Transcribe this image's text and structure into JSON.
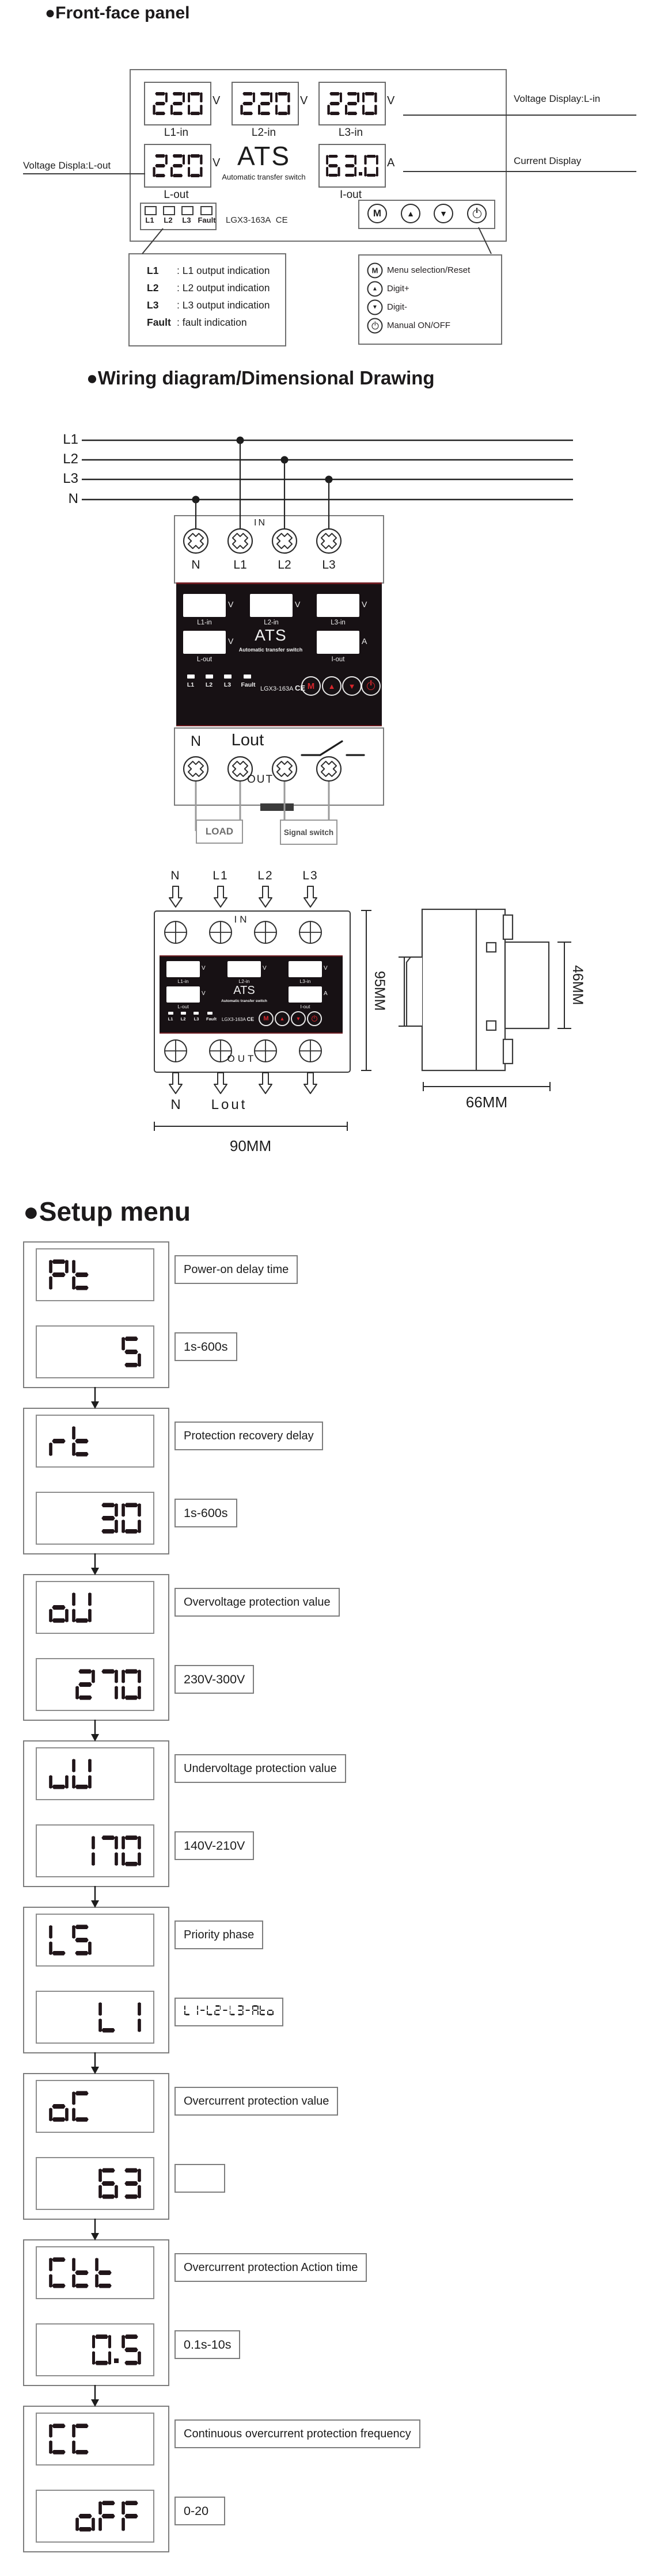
{
  "front_panel": {
    "heading": "●Front-face panel",
    "displays": {
      "l1_in": {
        "value": "220",
        "unit": "V",
        "caption": "L1-in"
      },
      "l2_in": {
        "value": "220",
        "unit": "V",
        "caption": "L2-in"
      },
      "l3_in": {
        "value": "220",
        "unit": "V",
        "caption": "L3-in"
      },
      "l_out": {
        "value": "220",
        "unit": "V",
        "caption": "L-out"
      },
      "i_out": {
        "value": "63.0",
        "unit": "A",
        "caption": "I-out"
      }
    },
    "ats_title": "ATS",
    "ats_subtitle": "Automatic transfer switch",
    "model": "LGX3-163A",
    "ce_mark": "CE",
    "indicators": [
      "L1",
      "L2",
      "L3",
      "Fault"
    ],
    "buttons": {
      "menu": "M",
      "up": "▲",
      "down": "▼"
    },
    "annotations": {
      "voltage_in": "Voltage Display:L-in",
      "current": "Current Display",
      "voltage_out": "Voltage Displa:L-out"
    },
    "legend_indicators": [
      {
        "key": "L1",
        "desc": ": L1 output indication"
      },
      {
        "key": "L2",
        "desc": ": L2 output indication"
      },
      {
        "key": "L3",
        "desc": ": L3 output indication"
      },
      {
        "key": "Fault",
        "desc": ": fault indication"
      }
    ],
    "legend_buttons": [
      {
        "glyph": "M",
        "desc": "Menu selection/Reset"
      },
      {
        "glyph": "▲",
        "desc": "Digit+"
      },
      {
        "glyph": "▼",
        "desc": "Digit-"
      },
      {
        "glyph": "power",
        "desc": "Manual ON/OFF"
      }
    ]
  },
  "device_face": {
    "captions": [
      "L1-in",
      "L2-in",
      "L3-in",
      "L-out",
      "I-out"
    ],
    "unit_v": "V",
    "unit_a": "A",
    "ats_title": "ATS",
    "ats_subtitle": "Automatic transfer switch",
    "model": "LGX3-163A",
    "ce_mark": "CE",
    "indicators": [
      "L1",
      "L2",
      "L3",
      "Fault"
    ],
    "buttons": {
      "menu": "M",
      "up": "▲",
      "down": "▼"
    }
  },
  "wiring": {
    "heading": "●Wiring diagram/Dimensional Drawing",
    "bus_labels": [
      "L1",
      "L2",
      "L3",
      "N"
    ],
    "in_terminal_labels": [
      "N",
      "L1",
      "L2",
      "L3"
    ],
    "in_label": "IN",
    "out_label": "OUT",
    "out_terminal_labels": {
      "n": "N",
      "lout": "Lout"
    },
    "load_label": "LOAD",
    "signal_switch_label": "Signal switch"
  },
  "dimensional": {
    "top_labels": [
      "N",
      "L1",
      "L2",
      "L3"
    ],
    "in_label": "IN",
    "out_label": "OUT",
    "bottom_labels": {
      "n": "N",
      "lout": "Lout"
    },
    "width_label": "90MM",
    "height_label": "95MM",
    "rail_label": "35MM",
    "front_depth_label": "46MM",
    "depth_label": "66MM"
  },
  "setup_menu": {
    "heading": "●Setup menu",
    "items": [
      {
        "code": "Pt",
        "value": "5",
        "name": "Power-on delay time",
        "range": "1s-600s"
      },
      {
        "code": "rt",
        "value": "30",
        "name": "Protection recovery delay",
        "range": "1s-600s"
      },
      {
        "code": "oU",
        "value": "270",
        "name": "Overvoltage protection value",
        "range": "230V-300V"
      },
      {
        "code": "uU",
        "value": "170",
        "name": "Undervoltage protection value",
        "range": "140V-210V"
      },
      {
        "code": "LS",
        "value": "L1",
        "name": "Priority phase",
        "range": "L1-L2-L3-Ato",
        "range_seg": true
      },
      {
        "code": "oC",
        "value": "63",
        "name": "Overcurrent protection value",
        "range": ""
      },
      {
        "code": "Ctt",
        "value": "0.5",
        "name": "Overcurrent protection Action time",
        "range": "0.1s-10s"
      },
      {
        "code": "CC",
        "value": "oFF",
        "name": "Continuous overcurrent protection frequency",
        "range": "0-20"
      }
    ]
  }
}
